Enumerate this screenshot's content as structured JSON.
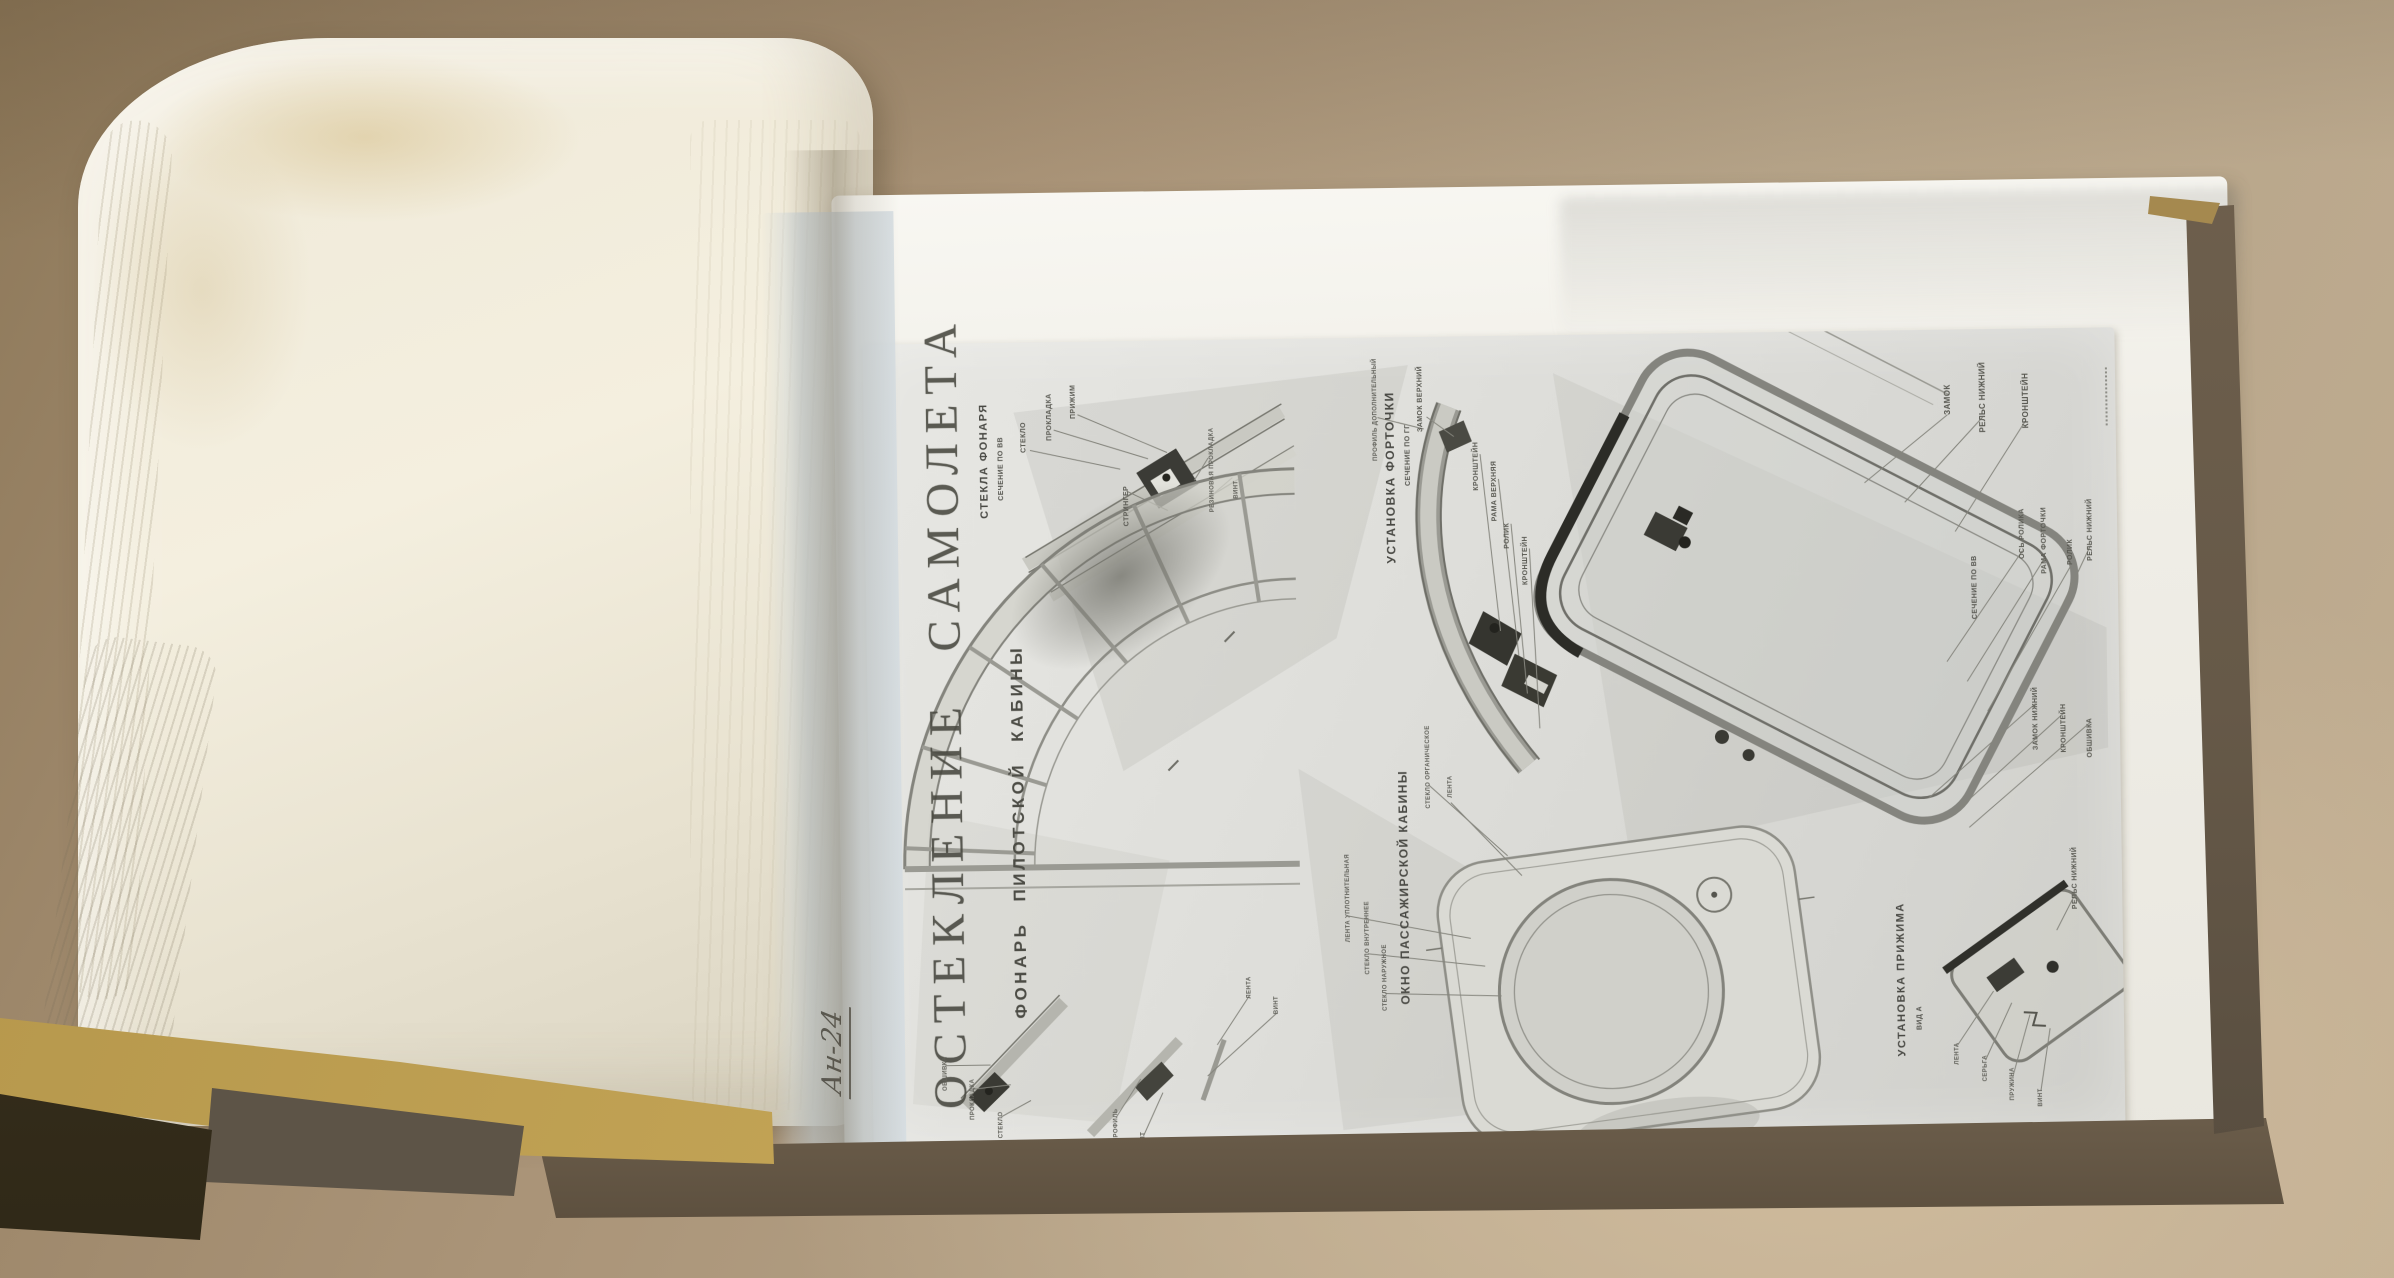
{
  "plate": {
    "brand": "Ан-24",
    "title": "ОСТЕКЛЕНИЕ САМОЛЕТА",
    "subtitle": "ФОНАРЬ ПИЛОТСКОЙ КАБИНЫ",
    "canopy_glass": {
      "heading": "СТЕКЛА ФОНАРЯ",
      "section_note": "СЕЧЕНИЕ ПО ВВ",
      "labels": [
        "СТЕКЛО",
        "ПРОКЛАДКА",
        "ПРИЖИМ",
        "СТРИНГЕР",
        "РЕЗИНОВАЯ ПРОКЛАДКА",
        "ВИНТ"
      ]
    },
    "vent_installation": {
      "heading": "УСТАНОВКА ФОРТОЧКИ",
      "section_note": "СЕЧЕНИЕ ПО ГГ",
      "labels": [
        "ПРОФИЛЬ ДОПОЛНИТЕЛЬНЫЙ",
        "ЗАМОК ВЕРХНИЙ",
        "КРОНШТЕЙН",
        "РАМА ВЕРХНЯЯ",
        "РОЛИК",
        "КРОНШТЕЙН"
      ]
    },
    "vent_frame": {
      "section_note": "СЕЧЕНИЕ ПО ВВ",
      "labels": [
        "ЗАМОК",
        "РЕЛЬС НИЖНИЙ",
        "КРОНШТЕЙН",
        "ОСЬ РОЛИКА",
        "РАМА ФОРТОЧКИ",
        "РОЛИК",
        "РЕЛЬС НИЖНИЙ",
        "ЗАМОК НИЖНИЙ",
        "КРОНШТЕЙН",
        "ОБШИВКА",
        "РЕЛЬС НИЖНИЙ"
      ]
    },
    "passenger_window": {
      "heading": "ОКНО ПАССАЖИРСКОЙ КАБИНЫ",
      "labels": [
        "СТЕКЛО ОРГАНИЧЕСКОЕ",
        "ЛЕНТА",
        "ЛЕНТА УПЛОТНИТЕЛЬНАЯ",
        "СТЕКЛО ВНУТРЕННЕЕ",
        "СТЕКЛО НАРУЖНОЕ"
      ]
    },
    "clamp_installation": {
      "heading": "УСТАНОВКА ПРИЖИМА",
      "section_note": "ВИД А",
      "labels": [
        "ЛЕНТА",
        "СЕРЬГА",
        "ПРУЖИНА",
        "ВИНТ"
      ]
    },
    "frame_details": {
      "labels": [
        "ОБШИВКА",
        "ПРОКЛАДКА",
        "СТЕКЛО",
        "ПРОФИЛЬ",
        "БОЛТ",
        "ЛЕНТА",
        "ВИНТ"
      ]
    }
  }
}
